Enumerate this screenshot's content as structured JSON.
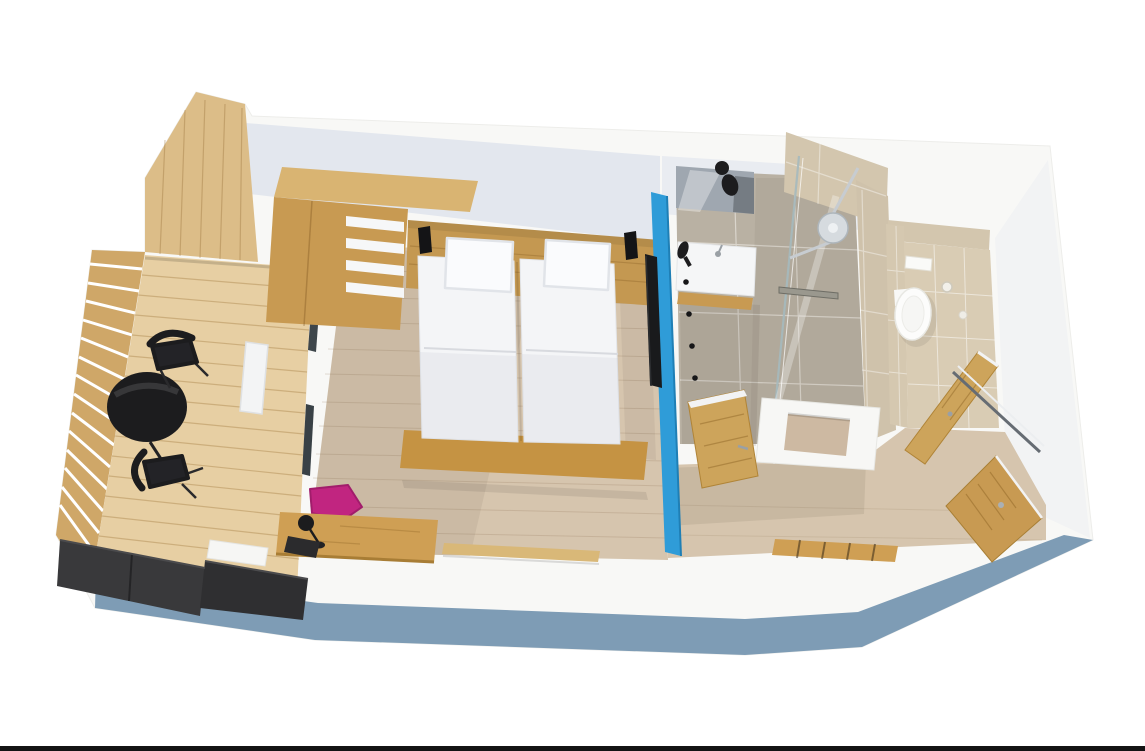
{
  "meta": {
    "description": "3D isometric cut-away rendering of a hotel room floor plan: wooden balcony with bistro table and two chairs, bedroom with twin beds, wardrobe with open shelves and desk with magenta chair, en-suite bathroom with washbasin, walk-in glass shower, separate WC, and entrance hallway with open wooden doors.",
    "canvas": {
      "width": 1145,
      "height": 751
    }
  },
  "scene": {
    "rooms": [
      {
        "name": "balcony"
      },
      {
        "name": "bedroom"
      },
      {
        "name": "bathroom"
      },
      {
        "name": "wc"
      },
      {
        "name": "hallway"
      }
    ],
    "objects": [
      "balcony-table",
      "balcony-chairs",
      "deck-planters",
      "wood-slat-railing",
      "twin-beds",
      "pillows",
      "headboard-with-reading-lamps",
      "wardrobe-with-shelves",
      "desk",
      "magenta-chair",
      "desk-lamp",
      "tv-panel",
      "blue-partition-wall",
      "washbasin",
      "mirror",
      "wall-hooks",
      "hairdryer",
      "glass-shower",
      "rain-shower-head",
      "floor-drain",
      "wall-hung-toilet",
      "flush-plate",
      "toilet-roll-holder",
      "bathroom-door",
      "wc-door",
      "entrance-door",
      "luggage-rack",
      "bench-board"
    ]
  },
  "palette": {
    "background": "#ffffff",
    "slab_white": "#f8f8f6",
    "wall_face": "#e3e7ee",
    "wall_face_bath": "#e9ecf1",
    "wall_face_soft": "#f2f3f4",
    "outer_blue": "#7e9cb5",
    "partition_blue": "#2f9cd8",
    "tv_black": "#191a1c",
    "bedroom_floor": "#d6c5ae",
    "bath_floor": "#b9b1a3",
    "tile_beige": "#d3c6ae",
    "wc_floor": "#d9ccb4",
    "deck_wood": "#e7cfa3",
    "railing_wood": "#cfa768",
    "panel_wood": "#dcbd88",
    "furniture_wood": "#c89a52",
    "wood_top": "#d9b472",
    "wood_dark": "#b8913f",
    "headboard_wood": "#c49851",
    "bed_base_wood": "#c59343",
    "door_wood": "#cda45b",
    "bench_wood": "#d9b878",
    "desk_wood": "#cf9f54",
    "mattress": "#f4f5f7",
    "pillow": "#fafbfd",
    "white_fixture": "#f5f6f7",
    "mirror": "#9fa7b0",
    "chrome": "#c7ccd1",
    "shower_head": "#d6dbdf",
    "drain": "#9a988e",
    "black": "#1c1c1e",
    "planter_a": "#39393b",
    "planter_b": "#2f2f31",
    "magenta": "#c12580",
    "window_glass": "#3e464b",
    "frame_dark": "#666c73",
    "niche_wood": "#cdb9a2",
    "bottom_bar": "#141414"
  }
}
